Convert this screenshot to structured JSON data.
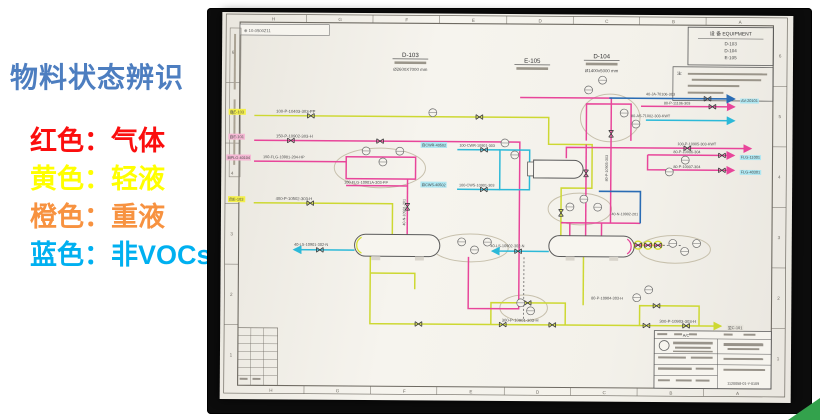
{
  "slide": {
    "title": "物料状态辨识",
    "legend": [
      {
        "label": "红色：气体",
        "color": "#fb0e0e"
      },
      {
        "label": "黄色：轻液",
        "color": "#ffff00"
      },
      {
        "label": "橙色：重液",
        "color": "#f79240"
      },
      {
        "label": "蓝色：非VOCs",
        "color": "#00b0f0"
      }
    ]
  },
  "drawing": {
    "ref_code": "⊕ 10-0500Z11",
    "grid_letters": [
      "H",
      "G",
      "F",
      "E",
      "D",
      "C",
      "B",
      "A"
    ],
    "grid_numbers": [
      "6",
      "5",
      "4",
      "3",
      "2",
      "1"
    ],
    "equipment_table": {
      "title": "设 备 EQUIPMENT",
      "items": [
        "D-103",
        "D-104",
        "E-105"
      ]
    },
    "notes_label": "注:",
    "title_block": {
      "rev": "A/C",
      "drawing_no": "1120058-01-Y-0109"
    },
    "labels": [
      {
        "t": "自E-103",
        "x": 8,
        "y": 102,
        "s": 4,
        "h": "#f3ef4a"
      },
      {
        "t": "自E-101",
        "x": 8,
        "y": 127,
        "s": 4,
        "h": "#f5b8d4"
      },
      {
        "t": "自FLG-40104",
        "x": 6,
        "y": 148,
        "s": 3.8,
        "h": "#f5b8d4"
      },
      {
        "t": "自E-103",
        "x": 8,
        "y": 190,
        "s": 4,
        "h": "#f3ef4a"
      },
      {
        "t": "100-P-10403-303-PP",
        "x": 55,
        "y": 101
      },
      {
        "t": "150-P-10902-303-H",
        "x": 55,
        "y": 126
      },
      {
        "t": "150-FLG-10901-204-HP",
        "x": 42,
        "y": 147,
        "s": 3.9
      },
      {
        "t": "100-FLG-10901A-303-PP",
        "x": 124,
        "y": 172,
        "s": 3.9
      },
      {
        "t": "400-P-10502-303-H",
        "x": 55,
        "y": 189
      },
      {
        "t": "40-N-10901-201",
        "x": 186,
        "y": 214,
        "r": -90,
        "s": 3.7
      },
      {
        "t": "40-LS-10901-302-N",
        "x": 74,
        "y": 235,
        "s": 3.9
      },
      {
        "t": "40-LS-10902-302-N",
        "x": 272,
        "y": 235,
        "s": 3.9
      },
      {
        "t": "自CWR-40502",
        "x": 202,
        "y": 134,
        "s": 3.8,
        "h": "#aee7f2"
      },
      {
        "t": "100-CWR-10901-303",
        "x": 240,
        "y": 134,
        "s": 3.8
      },
      {
        "t": "自CWS-40502",
        "x": 202,
        "y": 174,
        "s": 3.8,
        "h": "#aee7f2"
      },
      {
        "t": "100-CWS-10901-303",
        "x": 240,
        "y": 174,
        "s": 3.8
      },
      {
        "t": "300-P-10901-303-H",
        "x": 284,
        "y": 310
      },
      {
        "t": "300-P-10903-303-H",
        "x": 443,
        "y": 310
      },
      {
        "t": "80-P-10904-303-H",
        "x": 374,
        "y": 287,
        "s": 3.9
      },
      {
        "t": "80-P-10905-303",
        "x": 390,
        "y": 168,
        "r": -90,
        "s": 3.7
      },
      {
        "t": "100-P-10905-303-KWT",
        "x": 460,
        "y": 131,
        "s": 3.8
      },
      {
        "t": "80-P-11106-303",
        "x": 446,
        "y": 90,
        "s": 3.8
      },
      {
        "t": "40-JA-70106-303",
        "x": 428,
        "y": 81,
        "s": 3.8
      },
      {
        "t": "80-AS-71002-303-KWT",
        "x": 413,
        "y": 103,
        "s": 3.8
      },
      {
        "t": "80-P-10906-304",
        "x": 456,
        "y": 139,
        "s": 3.8
      },
      {
        "t": "80-P-10907-304",
        "x": 456,
        "y": 154,
        "s": 3.8
      },
      {
        "t": "40-N-10902-201",
        "x": 394,
        "y": 202,
        "s": 3.7
      },
      {
        "t": "AV-20101",
        "x": 524,
        "y": 87,
        "s": 3.9,
        "h": "#aee7f2"
      },
      {
        "t": "FLG-11001",
        "x": 524,
        "y": 144,
        "s": 3.9,
        "h": "#aee7f2"
      },
      {
        "t": "FLG-40301",
        "x": 524,
        "y": 159,
        "s": 3.9,
        "h": "#aee7f2"
      },
      {
        "t": "至C-101",
        "x": 512,
        "y": 316,
        "s": 4,
        "h": "#e6e3da"
      },
      {
        "t": "D-103",
        "x": 190,
        "y": 44,
        "s": 6.2,
        "a": "middle",
        "c": "#333333"
      },
      {
        "t": "Ø2600X7000 mm",
        "x": 190,
        "y": 58,
        "s": 4.4,
        "a": "middle"
      },
      {
        "t": "E-105",
        "x": 313,
        "y": 49,
        "s": 6.2,
        "a": "middle",
        "c": "#333333"
      },
      {
        "t": "D-104",
        "x": 383,
        "y": 44,
        "s": 6.2,
        "a": "middle",
        "c": "#333333"
      },
      {
        "t": "Ø1400x5000 mm",
        "x": 383,
        "y": 58,
        "s": 4.4,
        "a": "middle"
      }
    ]
  }
}
